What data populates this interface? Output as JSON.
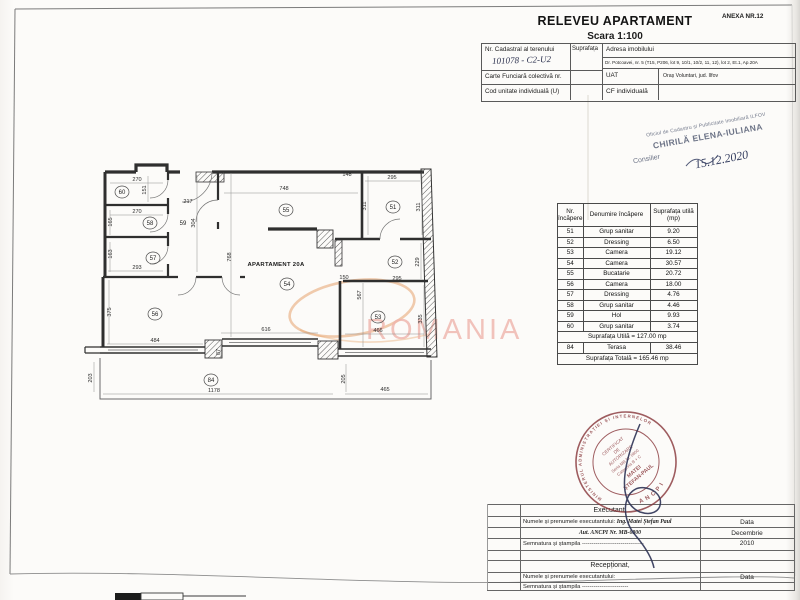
{
  "page": {
    "anexa": "ANEXA NR.12",
    "title": "RELEVEU APARTAMENT",
    "scale": "Scara 1:100"
  },
  "cadastral_table": {
    "nr_cadastral_label": "Nr. Cadastral al terenului",
    "nr_cadastral_value": "101078 - C2-U2",
    "suprafata_label": "Suprafața",
    "adresa_label": "Adresa imobilului",
    "adresa_value": "Dr. Potcoavei, nr. 5 (T15, P206, lot 9, 10/1, 10/2, 11, 12), lot 2, Et.1, Ap.20A",
    "carte_label": "Carte Funciară colectivă nr.",
    "uat_label": "UAT",
    "uat_value": "Oraș Voluntari, jud. Ilfov",
    "cod_label": "Cod unitate individuală  (U)",
    "cf_label": "CF  individuală"
  },
  "ocpi_stamp": {
    "office": "Oficiul de Cadastru și Publicitate Imobiliară ILFOV",
    "name": "CHIRILĂ ELENA-IULIANA",
    "role": "Consilier",
    "date": "15.12.2020"
  },
  "room_table": {
    "headers": [
      "Nr. încăpere",
      "Denumire încăpere",
      "Suprafața utilă (mp)"
    ],
    "rows": [
      [
        "51",
        "Grup sanitar",
        "9.20"
      ],
      [
        "52",
        "Dressing",
        "6.50"
      ],
      [
        "53",
        "Camera",
        "19.12"
      ],
      [
        "54",
        "Camera",
        "30.57"
      ],
      [
        "55",
        "Bucatarie",
        "20.72"
      ],
      [
        "56",
        "Camera",
        "18.00"
      ],
      [
        "57",
        "Dressing",
        "4.76"
      ],
      [
        "58",
        "Grup sanitar",
        "4.46"
      ],
      [
        "59",
        "Hol",
        "9.93"
      ],
      [
        "60",
        "Grup sanitar",
        "3.74"
      ]
    ],
    "suprafata_utila": "Suprafața Utilă  = 127.00 mp",
    "terasa_row": [
      "84",
      "Terasa",
      "38.46"
    ],
    "suprafata_totala": "Suprafața Totală  = 165.46 mp"
  },
  "plan": {
    "apartment_label": "APARTAMENT 20A",
    "rooms": [
      "60",
      "58",
      "57",
      "56",
      "59",
      "55",
      "54",
      "51",
      "52",
      "53",
      "84"
    ],
    "dims": [
      "270",
      "151",
      "217",
      "270",
      "165",
      "304",
      "163",
      "293",
      "375",
      "484",
      "748",
      "768",
      "148",
      "295",
      "311",
      "311",
      "295",
      "229",
      "150",
      "567",
      "466",
      "335",
      "616",
      "87",
      "203",
      "1178",
      "205",
      "465"
    ]
  },
  "watermark": {
    "text": "ROMANIA"
  },
  "round_stamp": {
    "ring": "MINISTERUL ADMINISTRAȚIEI ȘI INTERNELOR",
    "ring_bottom": "ANCPI",
    "line1": "CERTIFICAT",
    "line2": "DE",
    "line3": "AUTORIZARE",
    "line4": "Seria MB Nr. 0800",
    "line5": "Categoria B + C",
    "line6": "MATEI",
    "line7": "ȘTEFAN-PAUL"
  },
  "executant_table": {
    "executant_heading": "Executant,",
    "name_label": "Numele și prenumele executantului:",
    "name_value": "Ing. Matei Ștefan Paul",
    "aut_value": "Aut. ANCPI Nr. MB-0800",
    "semnatura_label": "Semnatura și ștampila",
    "dots": "--------------------------------",
    "data_label": "Data",
    "data_value_line1": "Decembrie",
    "data_value_line2": "2010",
    "receptionat_heading": "Recepționat,",
    "name_label2": "Numele și prenumele executantului:",
    "semnatura_label2": "Semnatura și ștampila",
    "dots2": "------------------------",
    "data_label2": "Data"
  }
}
